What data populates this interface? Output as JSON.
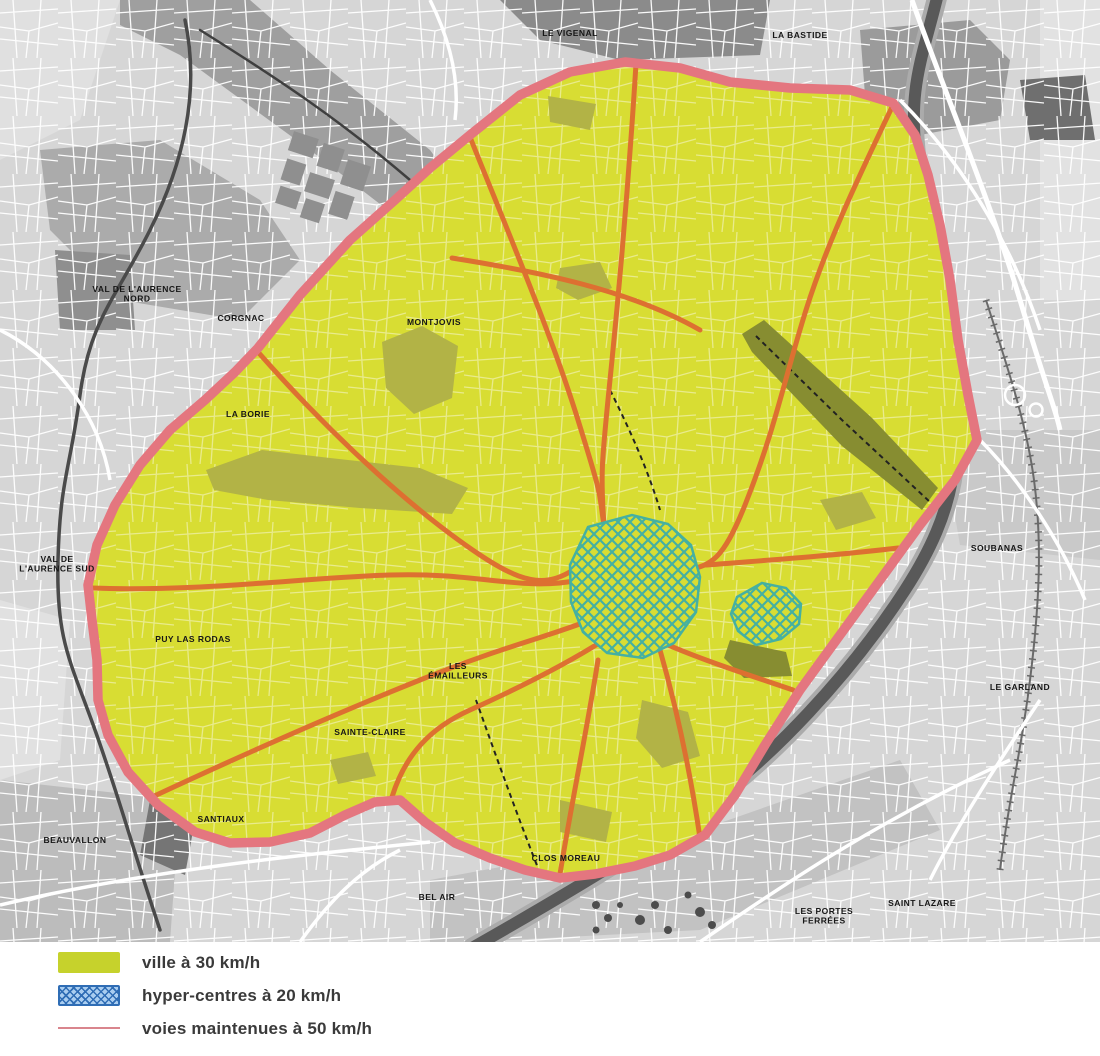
{
  "legend": {
    "items": [
      {
        "id": "ville",
        "label": "ville à 30 km/h",
        "swatch": "fill",
        "color": "#c6d22c"
      },
      {
        "id": "hyper",
        "label": "hyper-centres à 20 km/h",
        "swatch": "hatch",
        "color": "#a9cdf0",
        "line_color": "#2f6db5"
      },
      {
        "id": "voies",
        "label": "voies maintenues à 50 km/h",
        "swatch": "line",
        "color": "#d9858d"
      }
    ]
  },
  "map": {
    "colors": {
      "city_30_fill": "#d8dd33",
      "city_street": "#e9eb8c",
      "hyper_hatch": "#45b0a1",
      "boundary": "#e4767f",
      "main_road_50": "#dd7031",
      "outside_bg": "#d6d6d6",
      "river": "#595959"
    },
    "district_labels": [
      {
        "id": "le-vigenal",
        "lines": [
          "LE VIGENAL"
        ],
        "x": 570,
        "y": 36
      },
      {
        "id": "la-bastide",
        "lines": [
          "LA BASTIDE"
        ],
        "x": 800,
        "y": 38
      },
      {
        "id": "val-aurence-nord",
        "lines": [
          "VAL DE L'AURENCE",
          "NORD"
        ],
        "x": 137,
        "y": 292
      },
      {
        "id": "corgnac",
        "lines": [
          "CORGNAC"
        ],
        "x": 241,
        "y": 321
      },
      {
        "id": "montjovis",
        "lines": [
          "MONTJOVIS"
        ],
        "x": 434,
        "y": 325
      },
      {
        "id": "la-borie",
        "lines": [
          "LA BORIE"
        ],
        "x": 248,
        "y": 417
      },
      {
        "id": "val-aurence-sud",
        "lines": [
          "VAL DE",
          "L'AURENCE SUD"
        ],
        "x": 57,
        "y": 562
      },
      {
        "id": "puy-las-rodas",
        "lines": [
          "PUY LAS RODAS"
        ],
        "x": 193,
        "y": 642
      },
      {
        "id": "les-emailleurs",
        "lines": [
          "LES",
          "ÉMAILLEURS"
        ],
        "x": 458,
        "y": 669
      },
      {
        "id": "sainte-claire",
        "lines": [
          "SAINTE-CLAIRE"
        ],
        "x": 370,
        "y": 735
      },
      {
        "id": "santiaux",
        "lines": [
          "SANTIAUX"
        ],
        "x": 221,
        "y": 822
      },
      {
        "id": "beauvallon",
        "lines": [
          "BEAUVALLON"
        ],
        "x": 75,
        "y": 843
      },
      {
        "id": "bel-air",
        "lines": [
          "BEL AIR"
        ],
        "x": 437,
        "y": 900
      },
      {
        "id": "clos-moreau",
        "lines": [
          "CLOS MOREAU"
        ],
        "x": 566,
        "y": 861
      },
      {
        "id": "soubanas",
        "lines": [
          "SOUBANAS"
        ],
        "x": 997,
        "y": 551
      },
      {
        "id": "le-garland",
        "lines": [
          "LE GARLAND"
        ],
        "x": 1020,
        "y": 690
      },
      {
        "id": "les-portes-ferrees",
        "lines": [
          "LES PORTES",
          "FERRÉES"
        ],
        "x": 824,
        "y": 914
      },
      {
        "id": "saint-lazare",
        "lines": [
          "SAINT LAZARE"
        ],
        "x": 922,
        "y": 906
      }
    ]
  }
}
